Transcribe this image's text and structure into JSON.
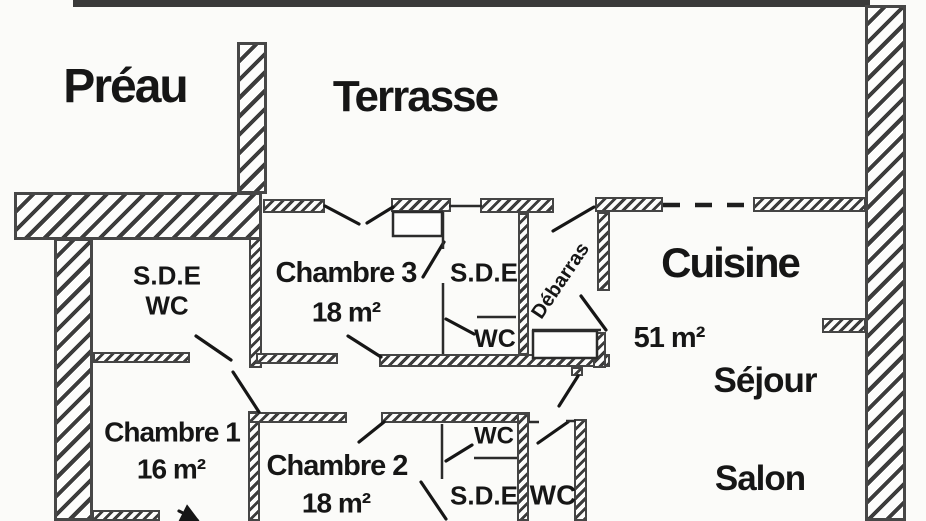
{
  "rooms": {
    "preau": {
      "label": "Préau"
    },
    "terrasse": {
      "label": "Terrasse"
    },
    "sde_wc": {
      "line1": "S.D.E",
      "line2": "WC"
    },
    "chambre3": {
      "label": "Chambre 3",
      "area": "18 m²"
    },
    "sde_top": {
      "label": "S.D.E"
    },
    "wc_top": {
      "label": "WC"
    },
    "debarras": {
      "label": "Débarras"
    },
    "cuisine": {
      "label": "Cuisine",
      "area": "51 m²"
    },
    "sejour": {
      "label": "Séjour"
    },
    "salon": {
      "label": "Salon"
    },
    "chambre1": {
      "label": "Chambre 1",
      "area": "16 m²"
    },
    "chambre2": {
      "label": "Chambre 2",
      "area": "18 m²"
    },
    "sde_bottom": {
      "label": "S.D.E"
    },
    "wc_bottom": {
      "label": "WC"
    },
    "wc_inner": {
      "label": "WC"
    }
  },
  "colors": {
    "ink": "#161616",
    "wall_stroke": "#454545",
    "paper": "#fbfbf9",
    "top_bar": "#3a3a3a"
  }
}
